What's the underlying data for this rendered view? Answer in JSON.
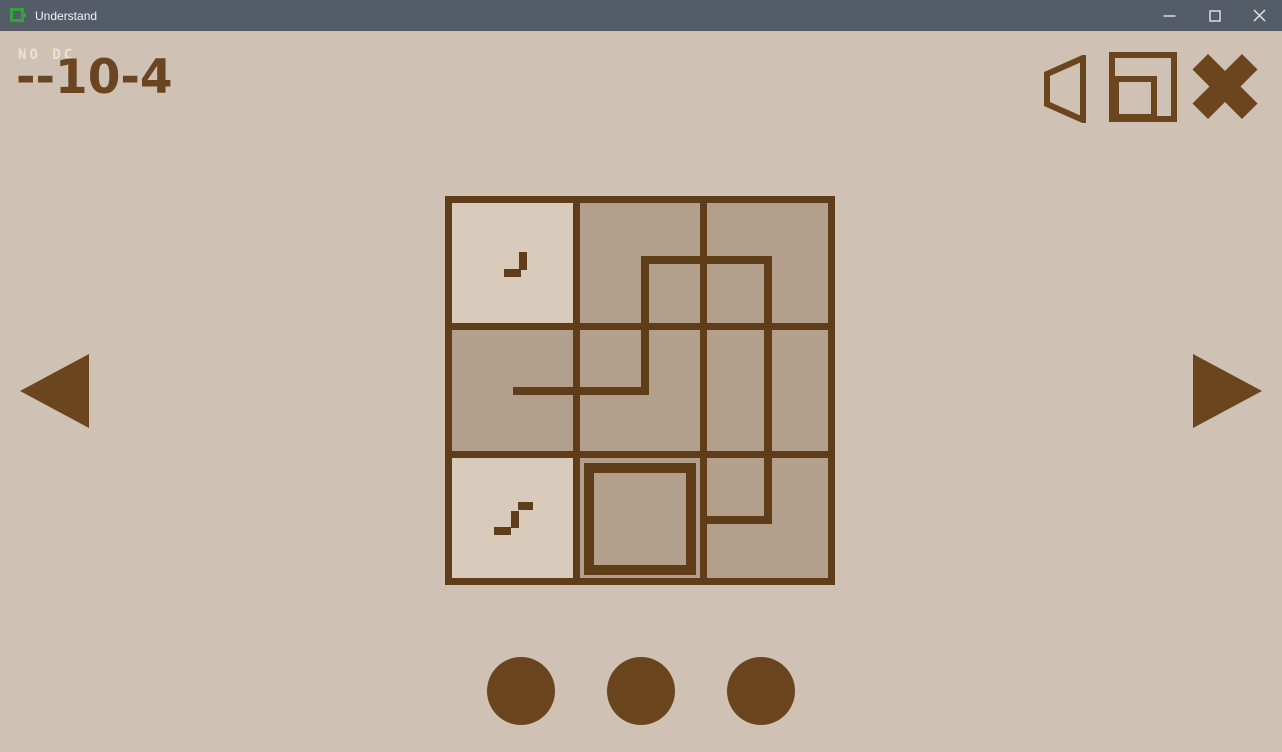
{
  "window": {
    "title": "Understand",
    "controls": {
      "minimize": "minimize",
      "maximize": "maximize",
      "close": "close"
    }
  },
  "header": {
    "modifier": "NO DC",
    "level_id": "--10-4"
  },
  "toolbar": {
    "sound": "speaker-icon",
    "window_mode": "window-icon",
    "exit": "x-icon"
  },
  "board": {
    "rows": 3,
    "cols": 3,
    "cells": [
      {
        "shade": "light",
        "icon": "step1"
      },
      {
        "shade": "dark",
        "icon": null
      },
      {
        "shade": "dark",
        "icon": null
      },
      {
        "shade": "dark",
        "icon": null
      },
      {
        "shade": "dark",
        "icon": null
      },
      {
        "shade": "dark",
        "icon": null
      },
      {
        "shade": "light",
        "icon": "step2"
      },
      {
        "shade": "dark",
        "icon": "square-outline"
      },
      {
        "shade": "dark",
        "icon": null
      }
    ],
    "path_points": "68,195 200,195 200,64 323,64 323,324 255,324",
    "inner_square": {
      "x": 144,
      "y": 272,
      "width": 102,
      "height": 102
    },
    "icons": {
      "step1": [
        [
          59,
          73,
          17,
          8
        ],
        [
          74,
          56,
          8,
          18
        ]
      ],
      "step2": [
        [
          49,
          331,
          17,
          8
        ],
        [
          66,
          315,
          8,
          17
        ],
        [
          73,
          306,
          15,
          8
        ]
      ]
    }
  },
  "nav": {
    "prev_label": "previous-level",
    "next_label": "next-level"
  },
  "progress": {
    "dot_count": 3
  },
  "colors": {
    "titlebar_bg": "#535c67",
    "titlebar_text": "#f2f2f2",
    "app_icon_green": "#2fa63a",
    "background": "#cfc1b4",
    "cell_light": "#d8cbbc",
    "cell_dark": "#b3a08c",
    "line_brown": "#5f3d18",
    "ui_brown": "#6a451d",
    "title_brown": "#6b4522",
    "modifier_text": "#ece2d4"
  }
}
